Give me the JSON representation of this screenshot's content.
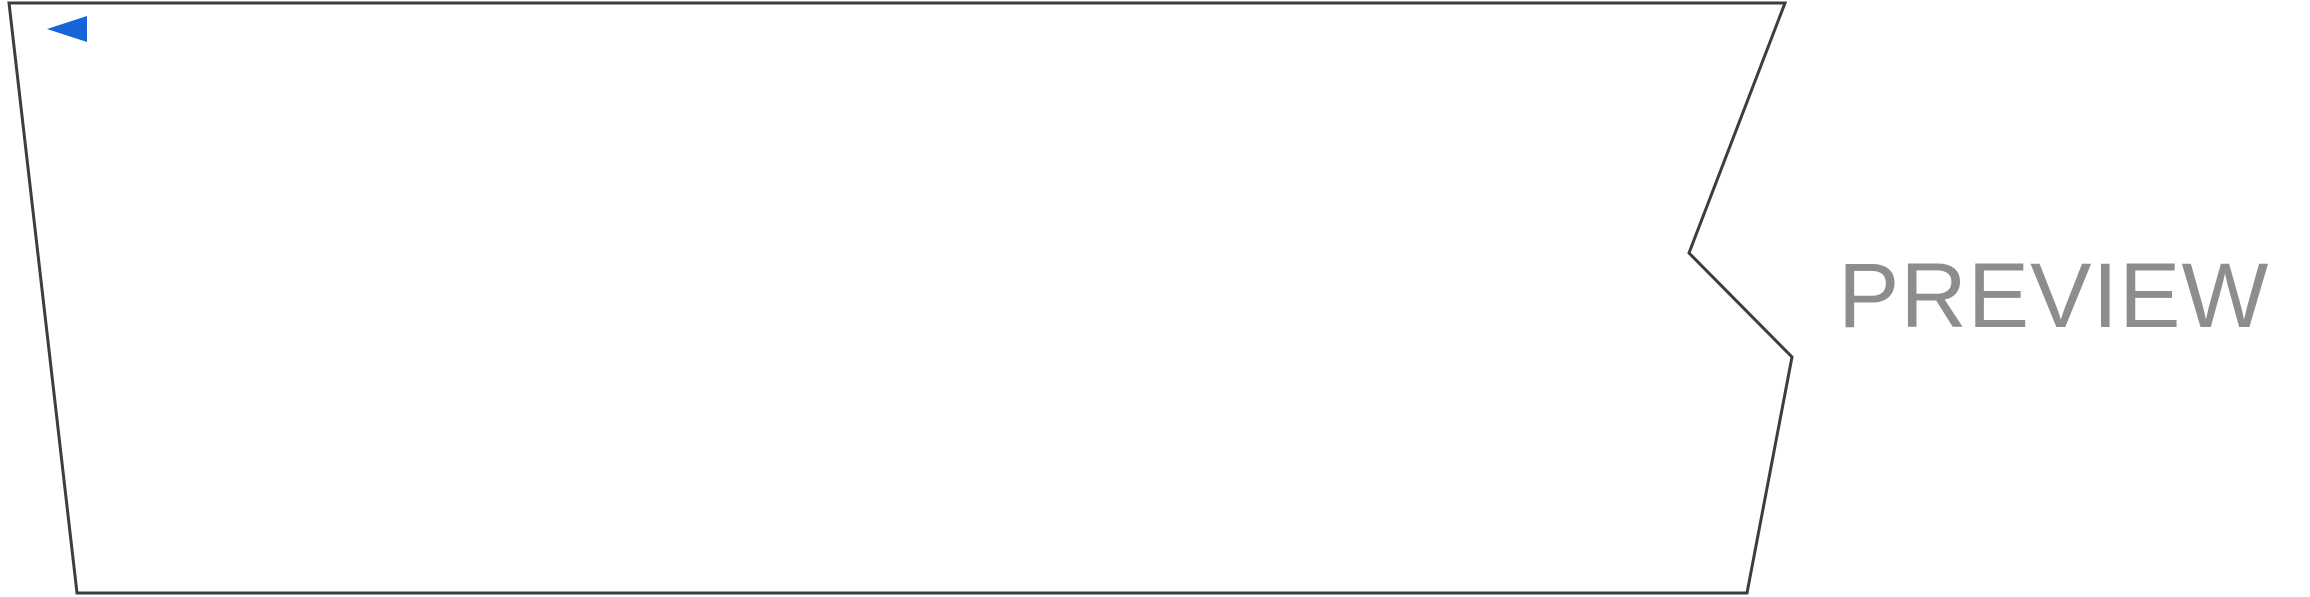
{
  "title": "30331□□ □□□ by sda13_s230209",
  "url_label": "https://musicboxmaniacs.com",
  "watermark": "PREVIEW",
  "player": {
    "play_icon": "play-triangle-left",
    "play_color": "#1565d8"
  },
  "strip": {
    "row_labels_top_to_bottom": [
      "E",
      "D",
      "C",
      "B",
      "A#",
      "A",
      "G#",
      "G",
      "F#",
      "F",
      "E",
      "D#",
      "D",
      "C#",
      "C",
      "B",
      "A#",
      "A",
      "G#",
      "G",
      "F#",
      "F",
      "E",
      "D",
      "C",
      "B",
      "A",
      "G",
      "D",
      "C"
    ],
    "octave_breaks_after_rows": [
      3,
      15,
      25
    ],
    "measure_numbers": [
      "3",
      "4",
      "5",
      "6",
      "7",
      "8"
    ],
    "first_visible_measure_number": 3,
    "shaded_measures": [
      2,
      4,
      6,
      8
    ],
    "notes": [
      {
        "cell": 0,
        "row": 20,
        "pitch": "G"
      },
      {
        "cell": 6,
        "row": 13,
        "pitch": "D"
      },
      {
        "cell": 8,
        "row": 15,
        "pitch": "C"
      },
      {
        "cell": 12,
        "row": 16,
        "pitch": "B"
      },
      {
        "cell": 15,
        "row": 18,
        "pitch": "A"
      },
      {
        "cell": 16,
        "row": 20,
        "pitch": "G"
      },
      {
        "cell": 17,
        "row": 22,
        "pitch": "F"
      },
      {
        "cell": 18,
        "row": 20,
        "pitch": "G"
      },
      {
        "cell": 23,
        "row": 25,
        "pitch": "C"
      },
      {
        "cell": 25,
        "row": 16,
        "pitch": "B"
      },
      {
        "cell": 28,
        "row": 18,
        "pitch": "A"
      },
      {
        "cell": 29,
        "row": 20,
        "pitch": "G"
      },
      {
        "cell": 30,
        "row": 22,
        "pitch": "F"
      },
      {
        "cell": 31,
        "row": 20,
        "pitch": "G"
      },
      {
        "cell": 35,
        "row": 25,
        "pitch": "C"
      },
      {
        "cell": 37,
        "row": 24,
        "pitch": "D"
      },
      {
        "cell": 43,
        "row": 24,
        "pitch": "D"
      }
    ],
    "colors": {
      "shading": "#e3e3e3",
      "grid_line": "#4c4c4c",
      "outline": "#3d3d3d",
      "note_fill": "#f3f3f3",
      "note_border": "#949494",
      "text": "#3a3a3a",
      "watermark": "#8d8d8d"
    }
  }
}
